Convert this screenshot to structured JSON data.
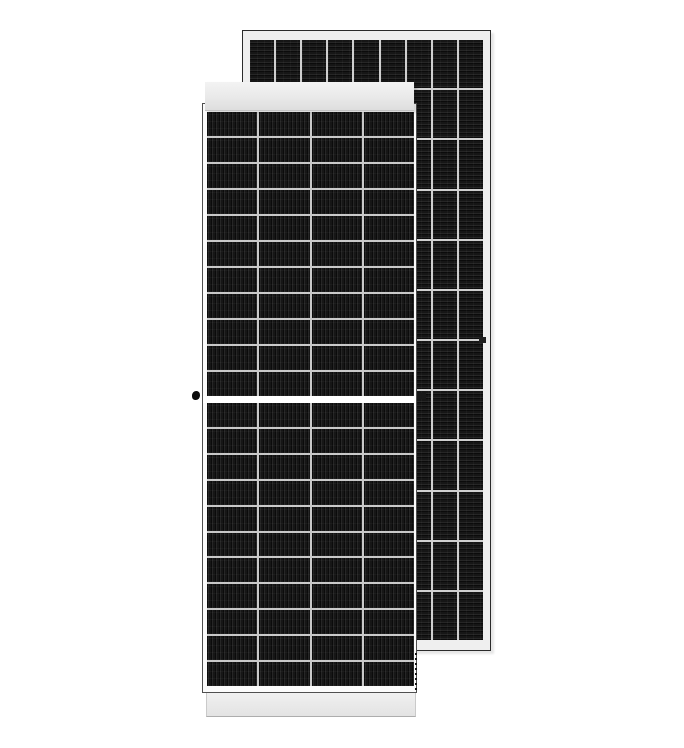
{
  "scene": {
    "description": "Product image of two monocrystalline solar panels on a white background: front portrait panel overlapping a rear panel offset up and to the right",
    "background_color": "#ffffff"
  },
  "palette": {
    "background": "#ffffff",
    "cell_dark": "#161616",
    "cell_line_dark": "#0b0b0b",
    "cell_line_light": "#262626",
    "front_gridline": "#c9c9c9",
    "rear_gridline": "#cfcfcf",
    "frame_light": "#efefef",
    "band_top": "#f3f3f3",
    "band_bottom": "#dedede",
    "outline_dark": "#2b2b2b"
  },
  "grids": {
    "front_top": {
      "rows": 11,
      "cols": 4,
      "orientation": "vertical"
    },
    "front_bottom": {
      "rows": 11,
      "cols": 4,
      "orientation": "vertical"
    },
    "rear": {
      "rows": 12,
      "cols": 9,
      "orientation": "horizontal"
    }
  },
  "front_panel": {
    "columns": 4,
    "rows_top_half": 11,
    "rows_bottom_half": 11,
    "has_center_divider": true,
    "grounding_hole": true
  },
  "rear_panel": {
    "columns": 9,
    "rows": 12
  }
}
